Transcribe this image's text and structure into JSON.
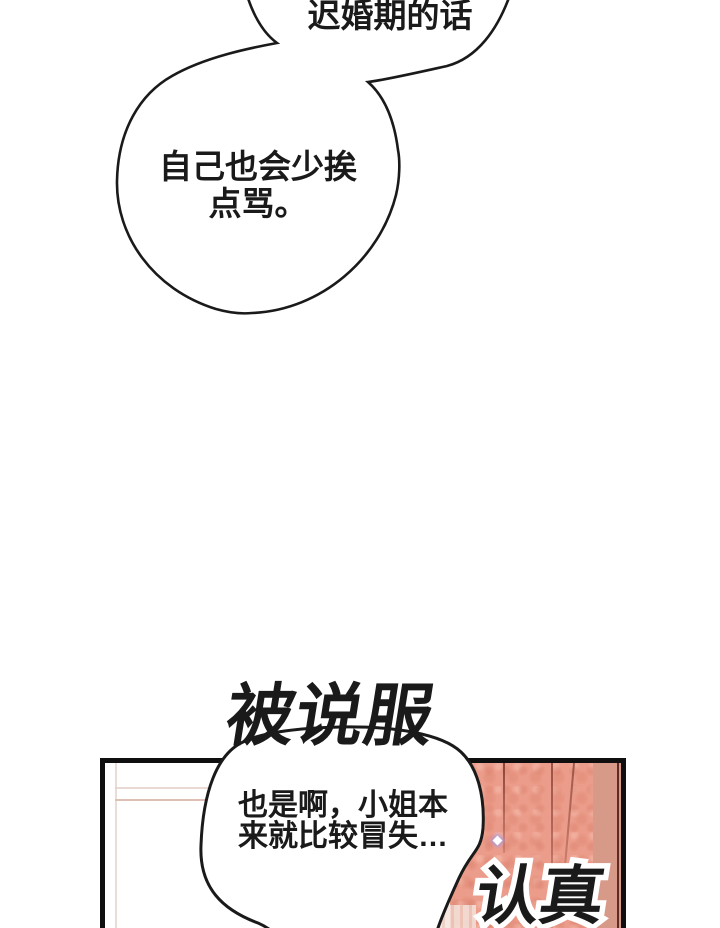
{
  "bubbles": {
    "bubble1": {
      "text": "迟婚期的话"
    },
    "bubble2": {
      "line1": "自己也会少挨",
      "line2": "点骂。"
    },
    "bubble3": {
      "line1": "也是啊，小姐本",
      "line2": "来就比较冒失…"
    }
  },
  "sfx": {
    "persuaded": "被说服",
    "serious": "认真"
  },
  "colors": {
    "ink": "#1a1a1a",
    "panel_border": "#0f0f0f",
    "curtain_base": "#ec9c8a",
    "curtain_fold": "#8a4438",
    "curtain_light": "#d79a88",
    "curtain_dark_edge": "#5f2b22",
    "wall_line_v": "#eadcd6",
    "wall_line_h1": "#e6d0c8",
    "wall_line_h2": "#dfc0b4",
    "stripe_light": "#f4e3dc",
    "stripe_dark": "#eccabd",
    "sparkle_glow": "#b09ade"
  }
}
